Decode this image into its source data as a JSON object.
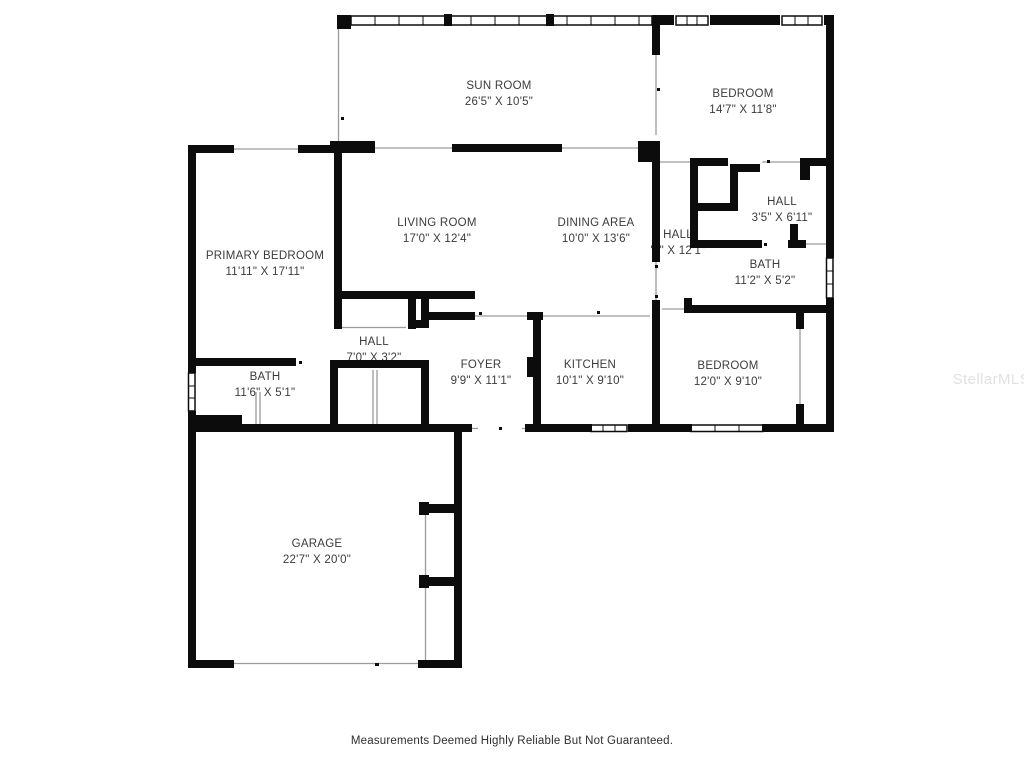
{
  "rooms": {
    "sun_room": {
      "name": "SUN ROOM",
      "dims": "26'5\" X 10'5\""
    },
    "bedroom_upper": {
      "name": "BEDROOM",
      "dims": "14'7\" X 11'8\""
    },
    "living_room": {
      "name": "LIVING ROOM",
      "dims": "17'0\" X 12'4\""
    },
    "dining_area": {
      "name": "DINING AREA",
      "dims": "10'0\" X 13'6\""
    },
    "hall_center": {
      "name": "HALL",
      "dims": "'1\" X 12'1\""
    },
    "hall_right": {
      "name": "HALL",
      "dims": "3'5\" X 6'11\""
    },
    "bath_right": {
      "name": "BATH",
      "dims": "11'2\" X 5'2\""
    },
    "primary_bedroom": {
      "name": "PRIMARY BEDROOM",
      "dims": "11'11\" X 17'11\""
    },
    "hall_small": {
      "name": "HALL",
      "dims": "7'0\" X 3'2\""
    },
    "foyer": {
      "name": "FOYER",
      "dims": "9'9\" X 11'1\""
    },
    "kitchen": {
      "name": "KITCHEN",
      "dims": "10'1\" X 9'10\""
    },
    "bedroom_lower": {
      "name": "BEDROOM",
      "dims": "12'0\" X 9'10\""
    },
    "bath_left": {
      "name": "BATH",
      "dims": "11'6\" X 5'1\""
    },
    "garage": {
      "name": "GARAGE",
      "dims": "22'7\" X 20'0\""
    }
  },
  "footer": {
    "disclaimer": "Measurements Deemed Highly Reliable But Not Guaranteed."
  },
  "watermark": {
    "text": "StellarMLS"
  }
}
